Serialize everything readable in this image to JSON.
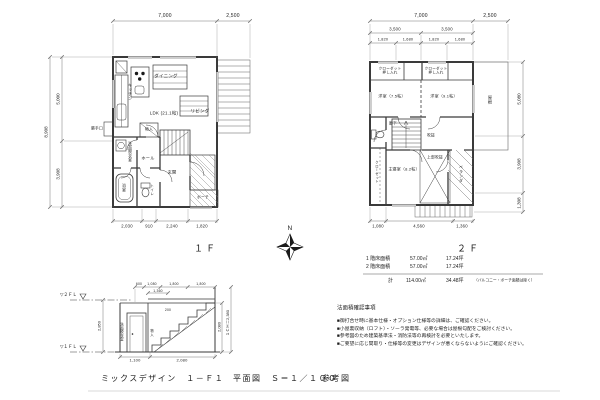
{
  "floor1": {
    "name_label": "１Ｆ",
    "dims": {
      "top_total": "7,000",
      "top_deck": "2,500",
      "left_total": "8,908",
      "left_upper": "5,000",
      "left_lower": "3,908",
      "bottom": [
        "2,030",
        "910",
        "2,240",
        "1,820"
      ]
    },
    "rooms": {
      "dining": "ダイニング",
      "kitchen": "キッチン",
      "ldk": "LDK (21.1帖)",
      "living": "リビング",
      "wash": "洗面脱衣室",
      "bath": "浴室",
      "backdoor": "勝手口",
      "hall": "ホール",
      "toilet": "トイレ",
      "closet": "物入",
      "entrance": "玄関",
      "porch": "ポーチ"
    }
  },
  "floor2": {
    "name_label": "２Ｆ",
    "dims": {
      "top_total": "7,000",
      "top_roof": "2,500",
      "mid": [
        "3,500",
        "3,500"
      ],
      "small": [
        "1,820",
        "1,680",
        "1,820",
        "1,680"
      ],
      "right": [
        "5,080",
        "3,908",
        "1,308"
      ],
      "bottom": [
        "1,080",
        "4,560",
        "1,360"
      ]
    },
    "rooms": {
      "closet1": "クローゼット\n押し入れ",
      "closet2": "クローゼット\n押し入れ",
      "bed1": "洋室（7.5帖）",
      "bed2": "洋室（9.1帖）",
      "hall": "廊下",
      "void_note": "吹抜",
      "closet_side": "クローゼット",
      "master": "主寝室（8.2帖）",
      "void_upper": "上部吹抜",
      "veranda": "ベランダ",
      "roof": "屋根"
    }
  },
  "compass": {
    "north": "N"
  },
  "area_table": {
    "rows": [
      {
        "name": "1 階床面積",
        "m2": "57.00㎡",
        "tsubo": "17.24坪"
      },
      {
        "name": "2 階床面積",
        "m2": "57.00㎡",
        "tsubo": "17.24坪"
      }
    ],
    "total": {
      "name": "計",
      "m2": "114.00㎡",
      "tsubo": "34.48坪",
      "note": "（バルコニー・ポーチ面積は除く）"
    }
  },
  "stair_section": {
    "fl2": "▽２ＦＬ",
    "fl1": "▽１ＦＬ",
    "dim_left": "2,850",
    "dims_top": [
      "600",
      "1,080",
      "1,800",
      "1,800"
    ],
    "dim_top2": "1,360",
    "dim_right_inner": "2,080",
    "dim_right_outer": "１ＣＨ＝2,380",
    "dims_bottom": [
      "1,100",
      "2,080"
    ],
    "label_room": "洗面脱衣室",
    "label_storage": "物入",
    "tread_note": "200"
  },
  "notes": {
    "heading": "法面積確認事項",
    "items": [
      "■御打合せ時に基本仕様・オプション仕様等の詳細は、ご確認ください。",
      "■小屋裏収納（ロフト）・ソーラ発電等、必要な場合は屋根勾配をご検討ください。",
      "■参考図のため建築基準法・消防法等の再検討を必要といたします。",
      "■ご要望に応じ間取り・仕様等の変更はデザインが悪くならないようにご確認ください。"
    ]
  },
  "title_block": {
    "project": "ミックスデザイン　１－Ｆ１",
    "drawing": "平面図　Ｓ＝１／１００",
    "doc_type": "参考図"
  }
}
